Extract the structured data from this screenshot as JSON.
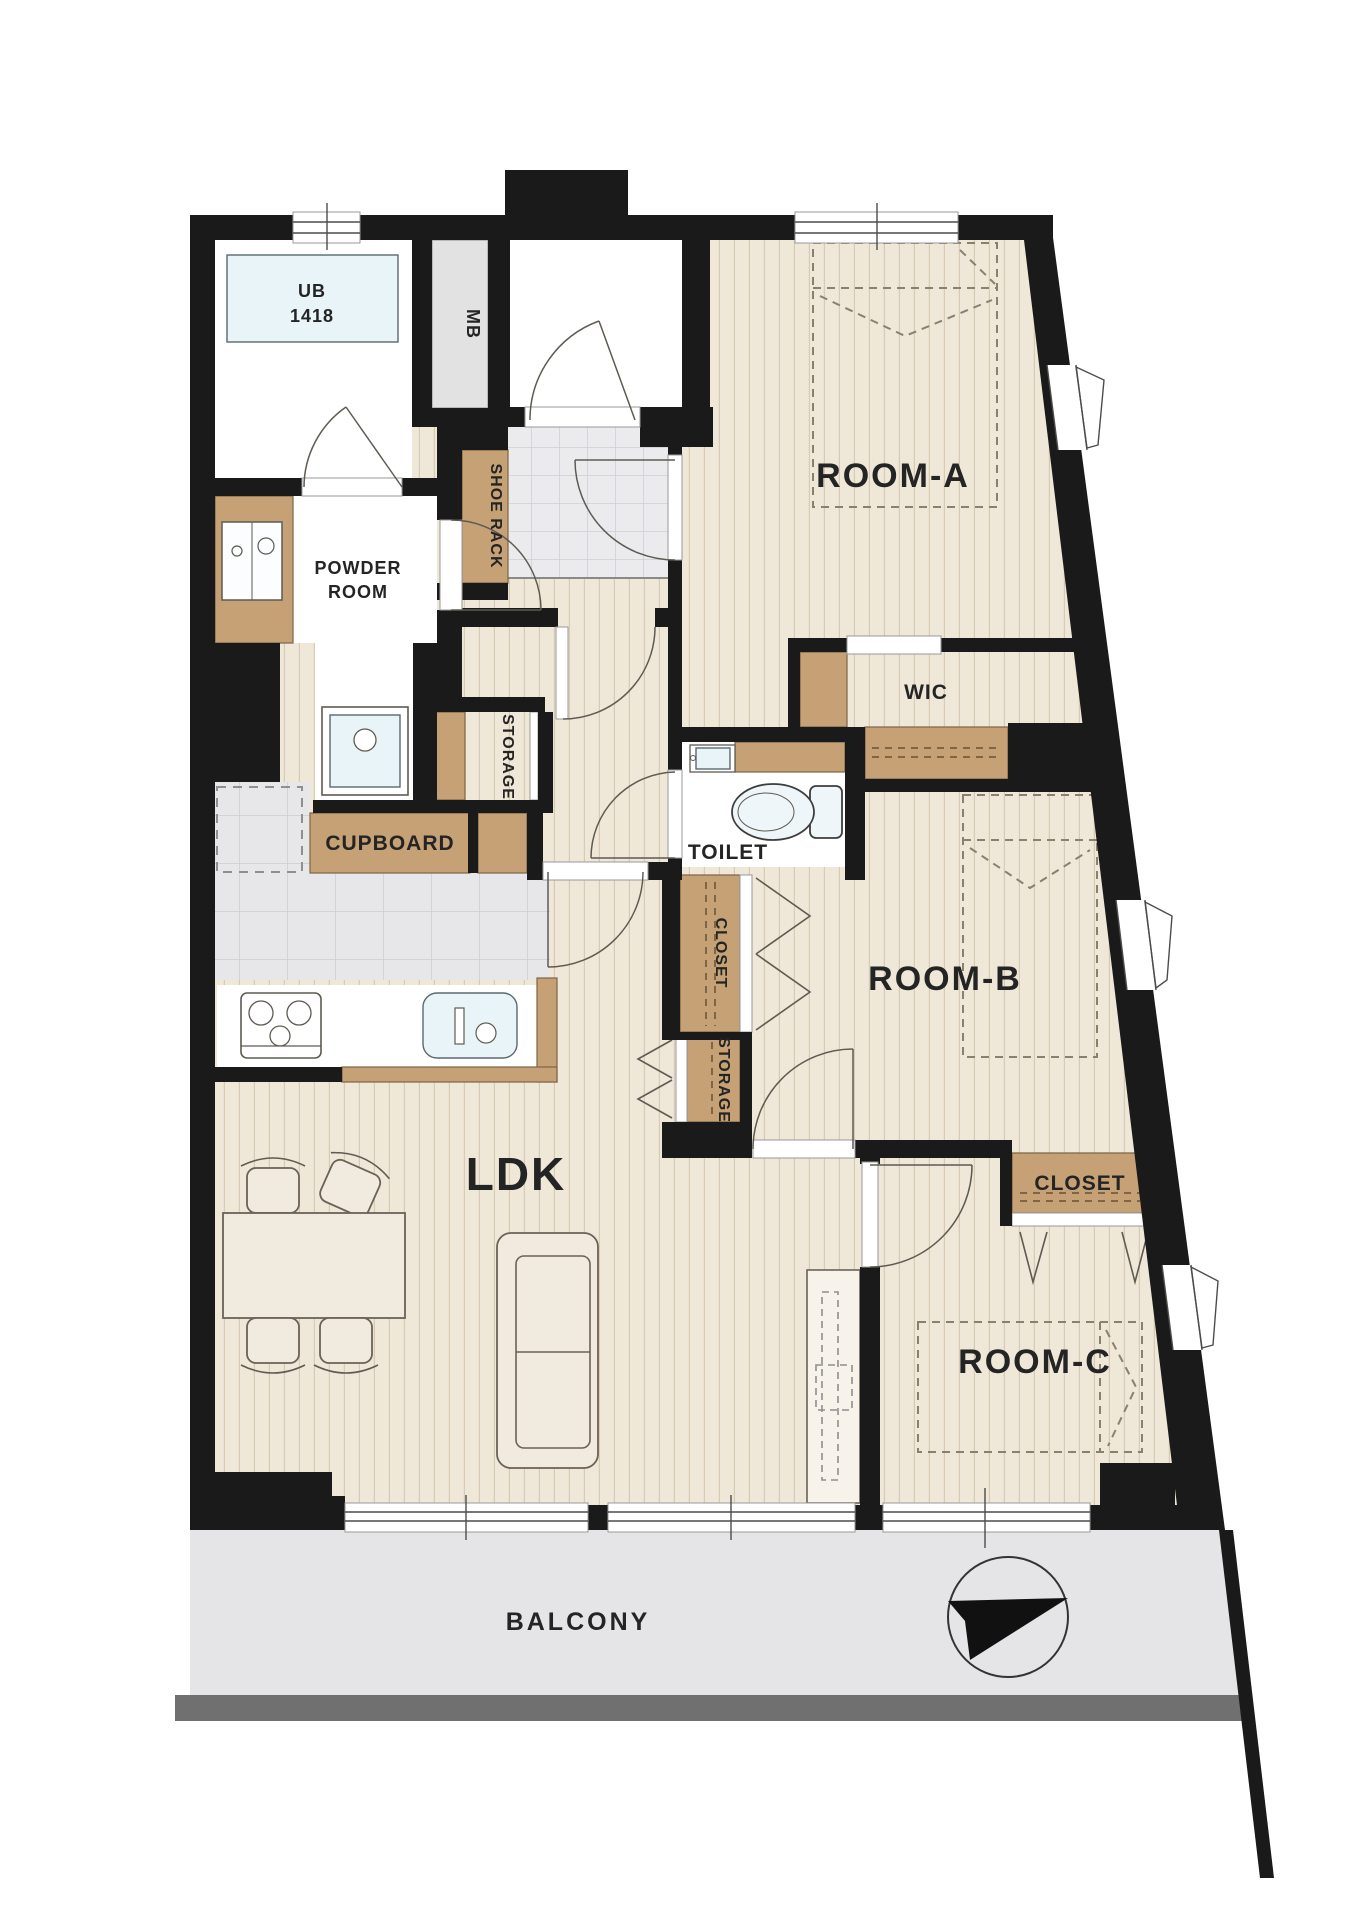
{
  "title": "3LDK apartment floor plan",
  "colors": {
    "wall": "#1a1a1a",
    "cabinet": "#c6a176",
    "floor": "#efe7d8",
    "tile": "#e9e9eb",
    "water": "#e8f4f7",
    "gray_box": "#e2e2e2",
    "balcony": "#e5e5e7",
    "balcony_edge": "#707070"
  },
  "rooms": {
    "room_a": {
      "label": "ROOM-A"
    },
    "room_b": {
      "label": "ROOM-B"
    },
    "room_c": {
      "label": "ROOM-C"
    },
    "ldk": {
      "label": "LDK"
    },
    "wic": {
      "label": "WIC"
    },
    "toilet": {
      "label": "TOILET"
    },
    "powder_room": {
      "line1": "POWDER",
      "line2": "ROOM"
    },
    "unit_bath": {
      "line1": "UB",
      "line2": "1418"
    },
    "balcony": {
      "label": "BALCONY"
    }
  },
  "storage": {
    "meter_box": "MB",
    "shoe_rack": "SHOE RACK",
    "storage_hall": "STORAGE",
    "storage_ldk": "STORAGE",
    "cupboard": "CUPBOARD",
    "closet_room_b": "CLOSET",
    "closet_room_c": "CLOSET"
  }
}
